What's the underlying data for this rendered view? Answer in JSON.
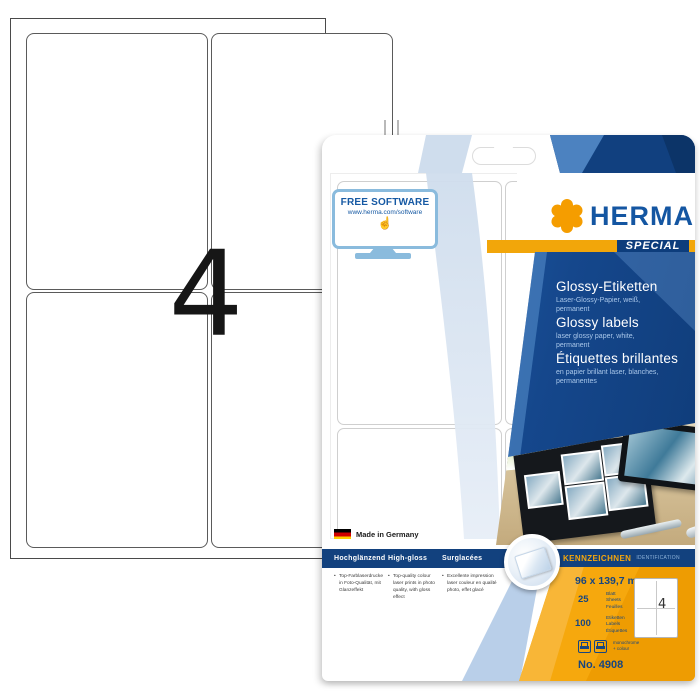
{
  "sheet": {
    "count_label": "4"
  },
  "package": {
    "free_software": {
      "title": "FREE SOFTWARE",
      "url": "www.herma.com/software"
    },
    "brand": "HERMA",
    "special_label": "SPECIAL",
    "titles": {
      "de": "Glossy-Etiketten",
      "de_sub": "Laser-Glossy-Papier, weiß,\npermanent",
      "en": "Glossy labels",
      "en_sub": "laser glossy paper, white,\npermanent",
      "fr": "Étiquettes brillantes",
      "fr_sub": "en papier brillant laser, blanches,\npermanentes"
    },
    "made_in": "Made in Germany",
    "features": {
      "headers": [
        "Hochglänzend",
        "High-gloss",
        "Surglacées"
      ],
      "bullets": [
        "Top-Farblaserdrucke in Foto-Qualität, mit Glanzeffekt",
        "Top-quality colour laser prints in photo quality, with gloss effect",
        "Excellente impression laser couleur en qualité photo, effet glacé"
      ]
    },
    "id_bar": {
      "kennzeichnen": "KENNZEICHNEN",
      "identification": "IDENTIFICATION"
    },
    "specs": {
      "size": "96 x 139,7 mm",
      "sheets_count": "25",
      "sheets_units": "Blatt\nSheets\nFeuilles",
      "labels_count": "100",
      "labels_units": "Etiketten\nLabels\nÉtiquettes",
      "printer_note": "monochrome\n+ colour",
      "item_no": "No. 4908",
      "diagram_count": "4"
    },
    "colors": {
      "brand_blue": "#1456a2",
      "accent_gold": "#f2a60a",
      "navy": "#12417e",
      "panel_orange": "#f6a80d"
    }
  }
}
